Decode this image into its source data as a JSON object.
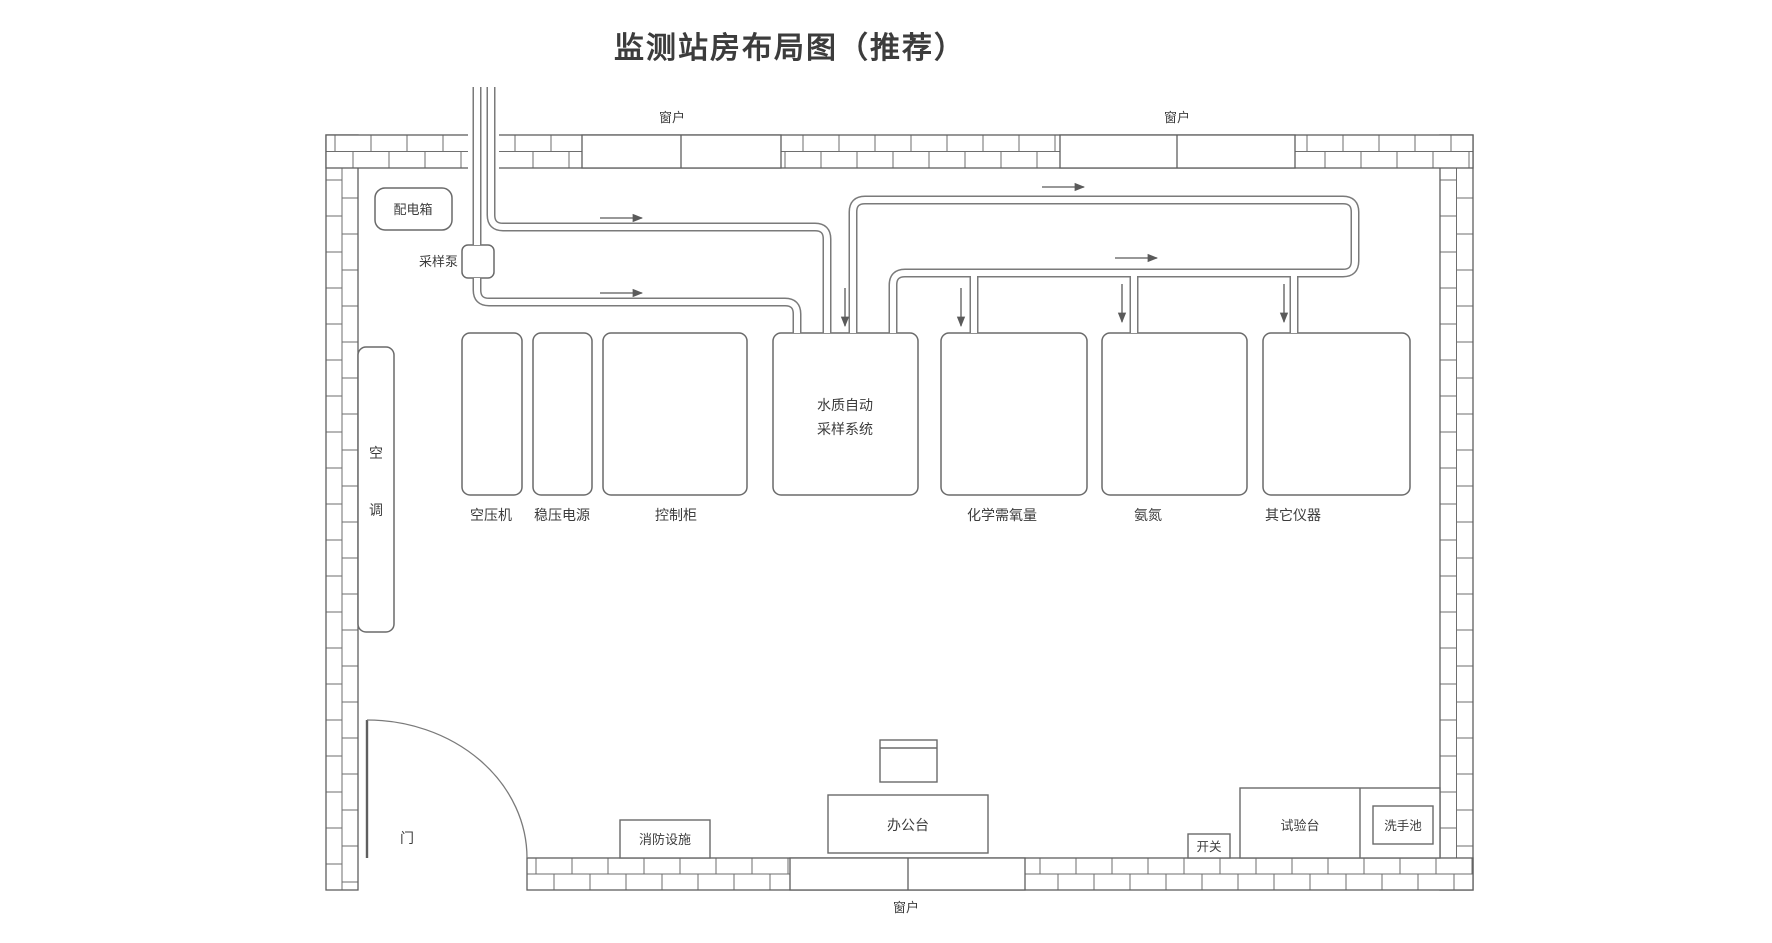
{
  "title": "监测站房布局图（推荐）",
  "title_color": "#2e5c8f",
  "labels": {
    "window": "窗户",
    "door": "门",
    "distribution_box": "配电箱",
    "sampling_pump": "采样泵",
    "air_conditioner": "空调",
    "air_conditioner_chars": [
      "空",
      "调"
    ],
    "fire_equipment": "消防设施",
    "office_desk": "办公台",
    "switch": "开关",
    "test_bench": "试验台",
    "wash_basin": "洗手池"
  },
  "equipment_row": [
    {
      "id": "air-compressor",
      "label": "空压机"
    },
    {
      "id": "regulated-power-supply",
      "label": "稳压电源"
    },
    {
      "id": "control-cabinet",
      "label": "控制柜"
    },
    {
      "id": "water-quality-auto-sampling-system",
      "label": "水质自动采样系统",
      "lines": [
        "水质自动",
        "采样系统"
      ]
    },
    {
      "id": "cod-analyzer",
      "label": "化学需氧量"
    },
    {
      "id": "ammonia-nitrogen",
      "label": "氨氮"
    },
    {
      "id": "other-instruments",
      "label": "其它仪器"
    }
  ]
}
